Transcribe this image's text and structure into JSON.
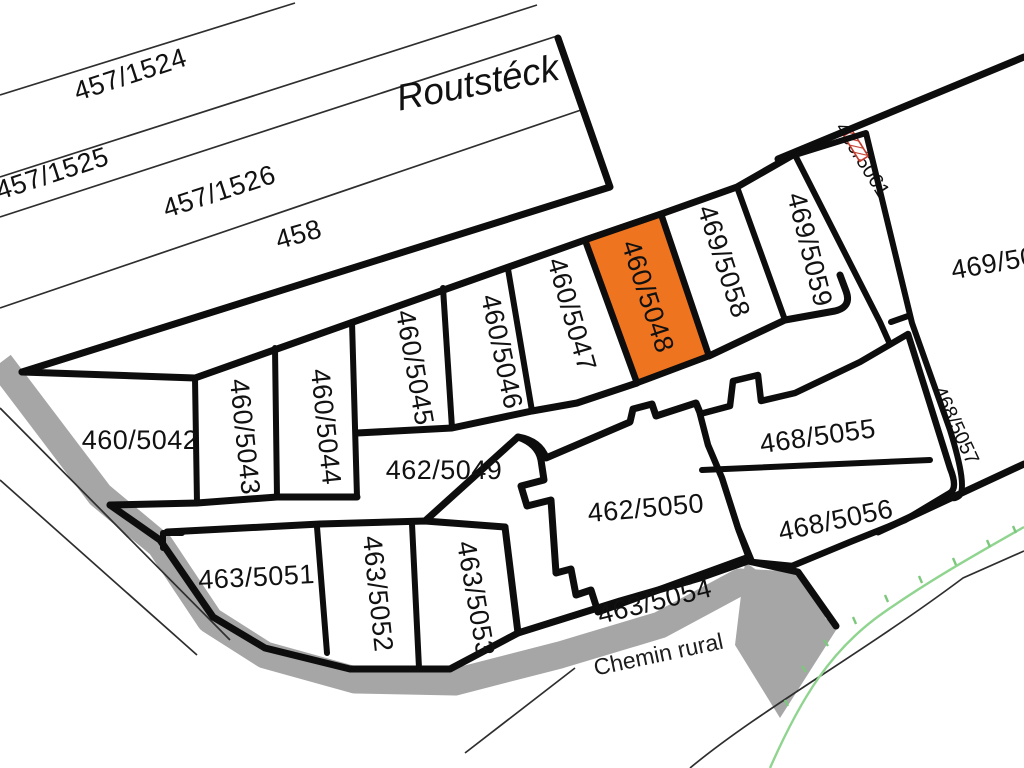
{
  "map": {
    "locality_label": "Routstéck",
    "road_label": "Chemin rural",
    "highlighted_parcel": "460/5048",
    "colors": {
      "background": "#ffffff",
      "boundary": "#0d0d0d",
      "road_band": "#a6a6a6",
      "highlight": "#ee7420",
      "highlight_label": "#5f2a06",
      "green_boundary": "#8fd48f",
      "red_marker": "#c43c2e",
      "label": "#111111"
    },
    "parcels": [
      {
        "label": "457/1524"
      },
      {
        "label": "457/1525"
      },
      {
        "label": "457/1526"
      },
      {
        "label": "458"
      },
      {
        "label": "460/5042"
      },
      {
        "label": "460/5043"
      },
      {
        "label": "460/5044"
      },
      {
        "label": "460/5045"
      },
      {
        "label": "460/5046"
      },
      {
        "label": "460/5047"
      },
      {
        "label": "460/5048",
        "highlighted": true
      },
      {
        "label": "469/5058"
      },
      {
        "label": "469/5059"
      },
      {
        "label": "469/5061"
      },
      {
        "label": "469/50",
        "truncated_at_edge": true
      },
      {
        "label": "468/5057"
      },
      {
        "label": "462/5049"
      },
      {
        "label": "462/5050"
      },
      {
        "label": "468/5055"
      },
      {
        "label": "468/5056"
      },
      {
        "label": "463/5051"
      },
      {
        "label": "463/5052"
      },
      {
        "label": "463/5053"
      },
      {
        "label": "463/5054"
      }
    ]
  }
}
